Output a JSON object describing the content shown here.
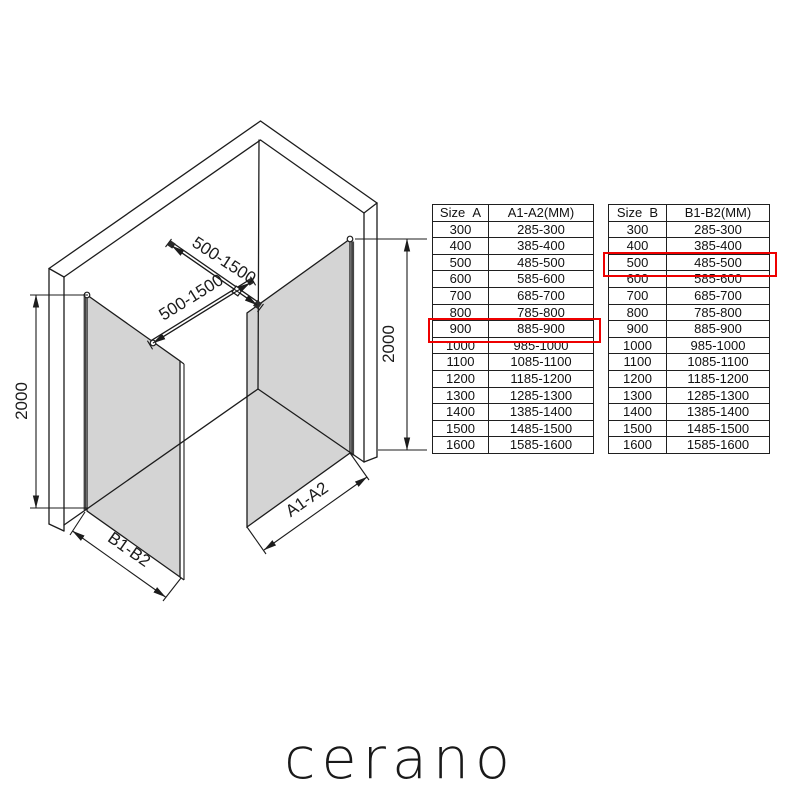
{
  "diagram": {
    "dim_height_left": "2000",
    "dim_height_right": "2000",
    "bar_length_top": "500-1500",
    "bar_length_bottom": "500-1500",
    "panel_b_width_label": "B1-B2",
    "panel_a_width_label": "A1-A2"
  },
  "tables": {
    "a": {
      "headers": [
        "Size  A",
        "A1-A2(MM)"
      ],
      "rows": [
        [
          "300",
          "285-300"
        ],
        [
          "400",
          "385-400"
        ],
        [
          "500",
          "485-500"
        ],
        [
          "600",
          "585-600"
        ],
        [
          "700",
          "685-700"
        ],
        [
          "800",
          "785-800"
        ],
        [
          "900",
          "885-900"
        ],
        [
          "1000",
          "985-1000"
        ],
        [
          "1100",
          "1085-1100"
        ],
        [
          "1200",
          "1185-1200"
        ],
        [
          "1300",
          "1285-1300"
        ],
        [
          "1400",
          "1385-1400"
        ],
        [
          "1500",
          "1485-1500"
        ],
        [
          "1600",
          "1585-1600"
        ]
      ],
      "highlight_size": "900",
      "highlight_range": "885-900"
    },
    "b": {
      "headers": [
        "Size  B",
        "B1-B2(MM)"
      ],
      "rows": [
        [
          "300",
          "285-300"
        ],
        [
          "400",
          "385-400"
        ],
        [
          "500",
          "485-500"
        ],
        [
          "600",
          "585-600"
        ],
        [
          "700",
          "685-700"
        ],
        [
          "800",
          "785-800"
        ],
        [
          "900",
          "885-900"
        ],
        [
          "1000",
          "985-1000"
        ],
        [
          "1100",
          "1085-1100"
        ],
        [
          "1200",
          "1185-1200"
        ],
        [
          "1300",
          "1285-1300"
        ],
        [
          "1400",
          "1385-1400"
        ],
        [
          "1500",
          "1485-1500"
        ],
        [
          "1600",
          "1585-1600"
        ]
      ],
      "highlight_size": "500",
      "highlight_range": "485-500"
    }
  },
  "logo": {
    "text": "cerano"
  },
  "colors": {
    "highlight": "#ee0000",
    "line": "#1c1c1c",
    "glass": "#d4d4d4"
  }
}
